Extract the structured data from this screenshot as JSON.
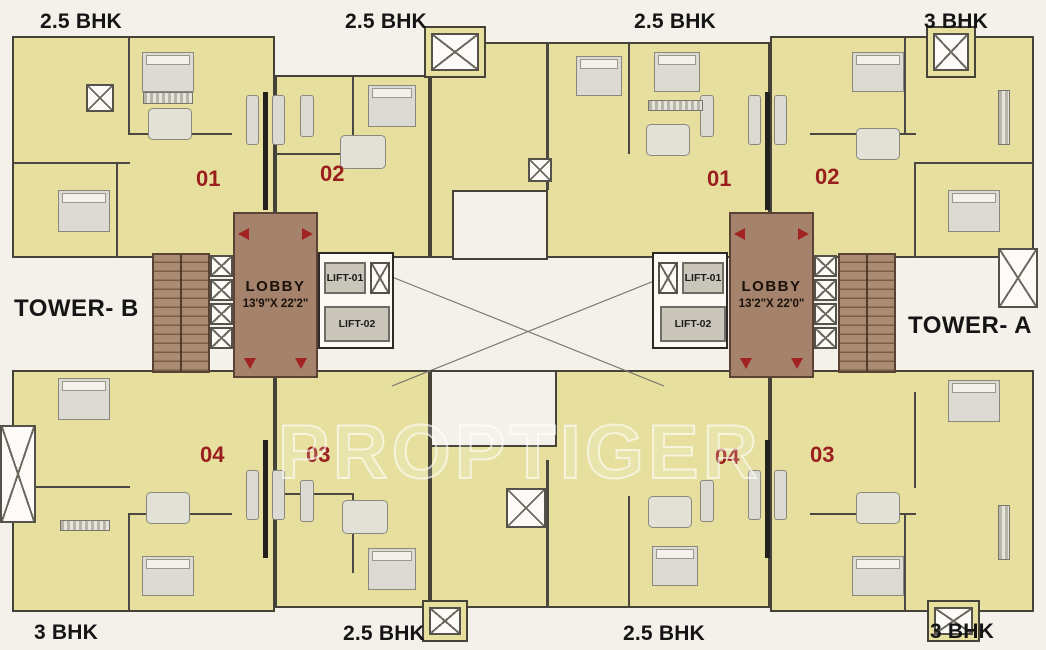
{
  "watermark": "PROPTIGER",
  "bhk_labels": {
    "top": [
      "2.5 BHK",
      "2.5 BHK",
      "2.5 BHK",
      "3 BHK"
    ],
    "bottom": [
      "3 BHK",
      "2.5 BHK",
      "2.5 BHK",
      "3 BHK"
    ]
  },
  "towers": {
    "b": {
      "label": "TOWER- B",
      "lobby_title": "LOBBY",
      "lobby_dims": "13'9\"X 22'2\"",
      "lift1": "LIFT-01",
      "lift2": "LIFT-02",
      "units": {
        "u01": "01",
        "u02": "02",
        "u03": "03",
        "u04": "04"
      }
    },
    "a": {
      "label": "TOWER- A",
      "lobby_title": "LOBBY",
      "lobby_dims": "13'2\"X 22'0\"",
      "lift1": "LIFT-01",
      "lift2": "LIFT-02",
      "units": {
        "u01": "01",
        "u02": "02",
        "u03": "03",
        "u04": "04"
      }
    }
  },
  "colors": {
    "unit_fill": "#e6df9e",
    "lobby_fill": "#a5826b",
    "accent_red": "#9a1e1e",
    "background": "#f4f1ea"
  }
}
